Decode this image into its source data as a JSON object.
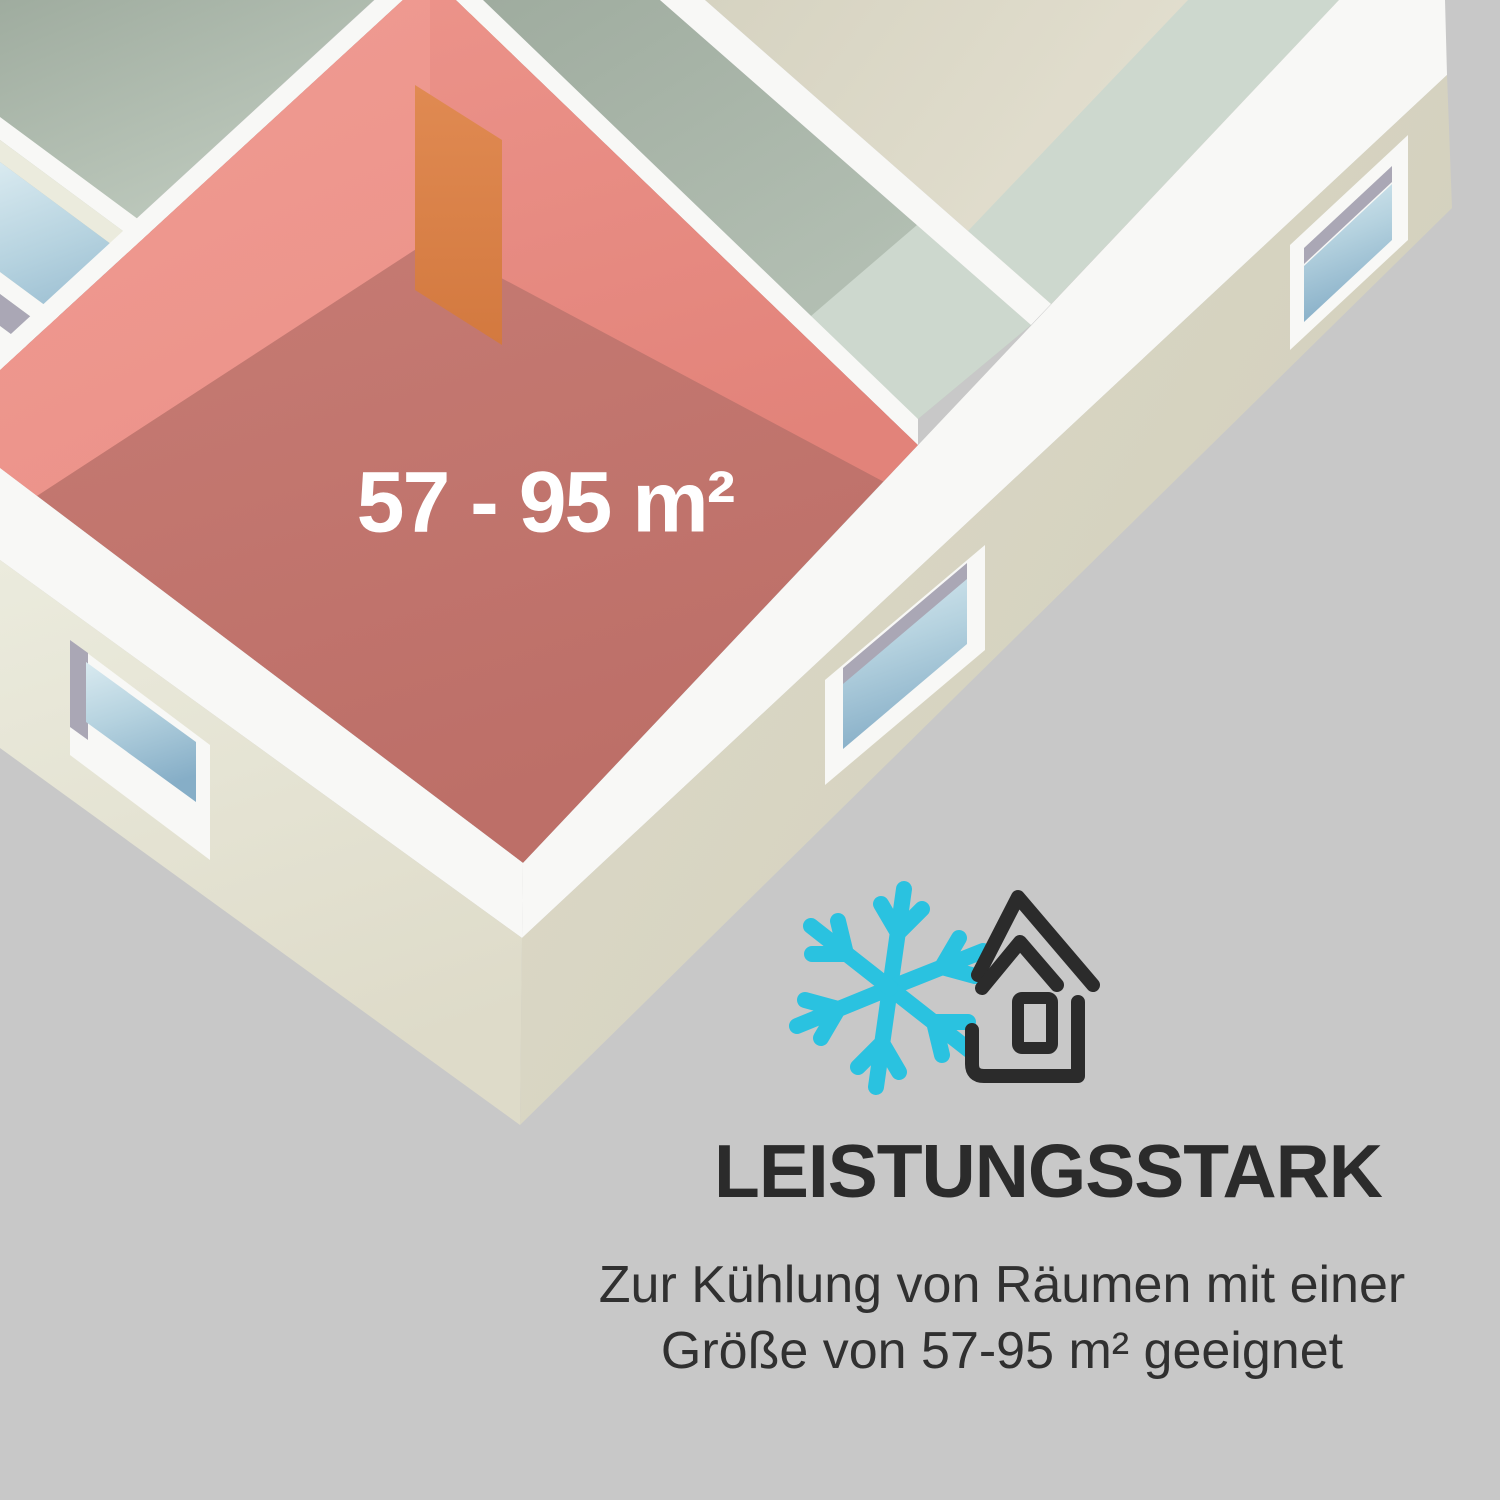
{
  "room": {
    "area_label": "57 - 95 m²"
  },
  "feature": {
    "heading": "LEISTUNGSSTARK",
    "description_line1": "Zur Kühlung von Räumen mit einer",
    "description_line2": "Größe von 57-95 m² geeignet"
  },
  "icons": {
    "snowflake": "snowflake-icon",
    "house": "house-icon"
  },
  "colors": {
    "background": "#c8c8c8",
    "band_white": "#f8f8f6",
    "cream_light": "#ebebdd",
    "cream": "#dedbc9",
    "cream_dark": "#d2cfbc",
    "sage_dark": "#9fac9f",
    "sage": "#b9c5b9",
    "sage_light": "#c9d4c8",
    "mint": "#cdd8ce",
    "beige": "#d6d3c1",
    "beige_light": "#e6e2d3",
    "red_wall": "#f09c93",
    "red_wall_mid": "#ec938a",
    "red_wall_dark": "#e2837a",
    "red_floor": "#c98078",
    "red_floor_dark": "#bd6f68",
    "door_orange": "#e08a52",
    "door_orange_dark": "#d3793f",
    "glass_light": "#d9eaf0",
    "glass_mid": "#b5d2df",
    "glass_deep": "#86aec7",
    "lilac": "#aaa7b5",
    "accent_cyan": "#2ac2e0",
    "ink": "#2b2b2b",
    "text_body": "#303030",
    "label_white": "#ffffff"
  }
}
